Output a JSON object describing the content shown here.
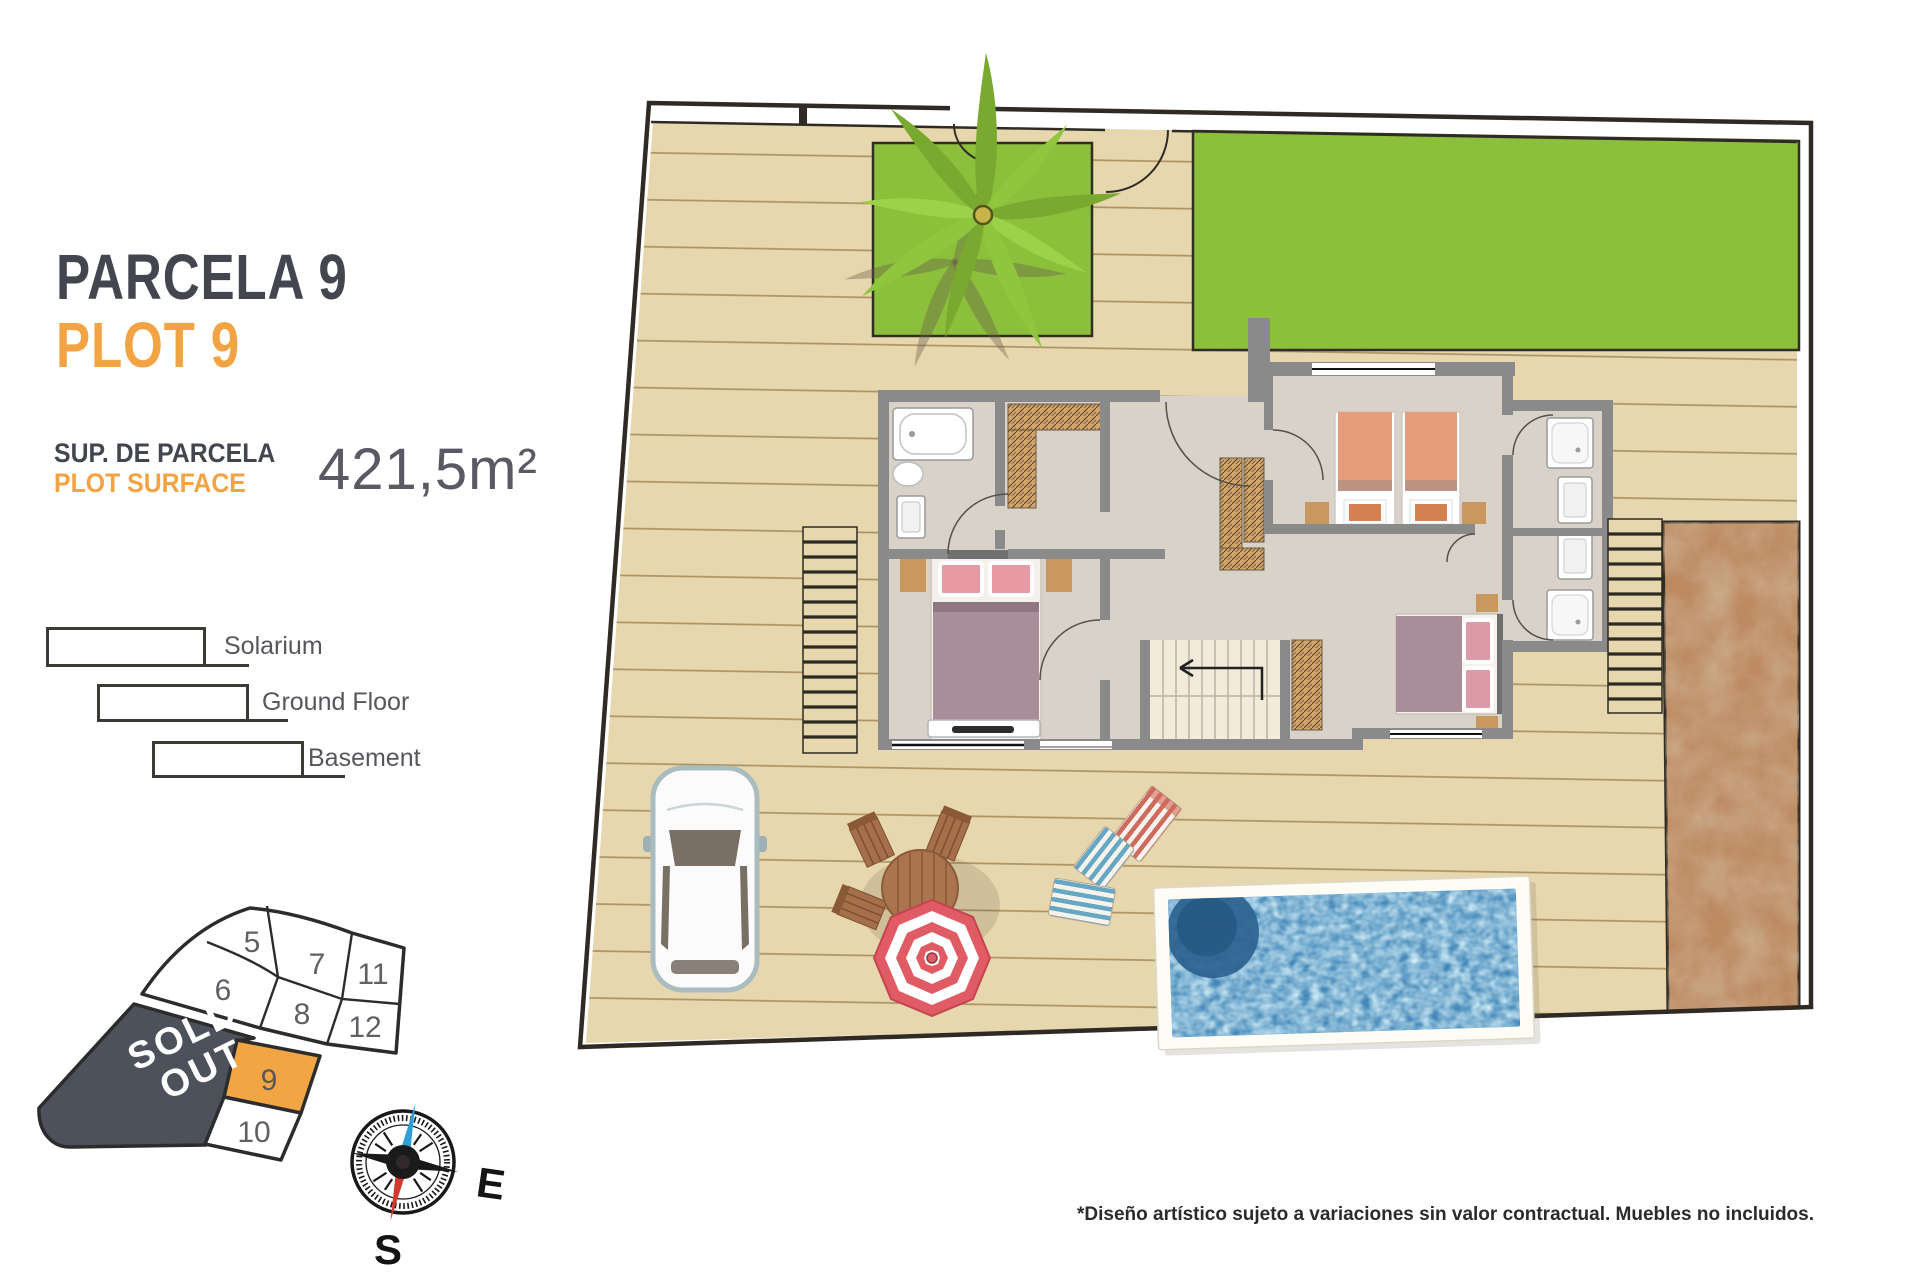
{
  "panel": {
    "title_primary": "PARCELA 9",
    "title_secondary": "PLOT 9",
    "surface_label_primary": "SUP. DE PARCELA",
    "surface_label_secondary": "PLOT SURFACE",
    "surface_value": "421,5m²"
  },
  "legend": {
    "items": [
      "Solarium",
      "Ground Floor",
      "Basement"
    ]
  },
  "minimap": {
    "plots": [
      "5",
      "7",
      "11",
      "6",
      "8",
      "12",
      "9",
      "10"
    ],
    "sold_out": [
      "SOLD",
      "OUT"
    ],
    "highlighted_plot": "9"
  },
  "compass": {
    "east": "E",
    "south": "S"
  },
  "footer": {
    "disclaimer": "*Diseño artístico sujeto a variaciones sin valor contractual. Muebles no incluidos."
  },
  "colors": {
    "accent_orange": "#F2A444",
    "title_gray": "#43464F",
    "sold_out_bg": "#4D515C",
    "plot9_fill": "#F2A643",
    "deck": "#E7D7AE",
    "grass": "#8CBF3C",
    "water": "#4287B8",
    "dirt": "#BD8A61",
    "wall_gray": "#8A8A8A"
  }
}
